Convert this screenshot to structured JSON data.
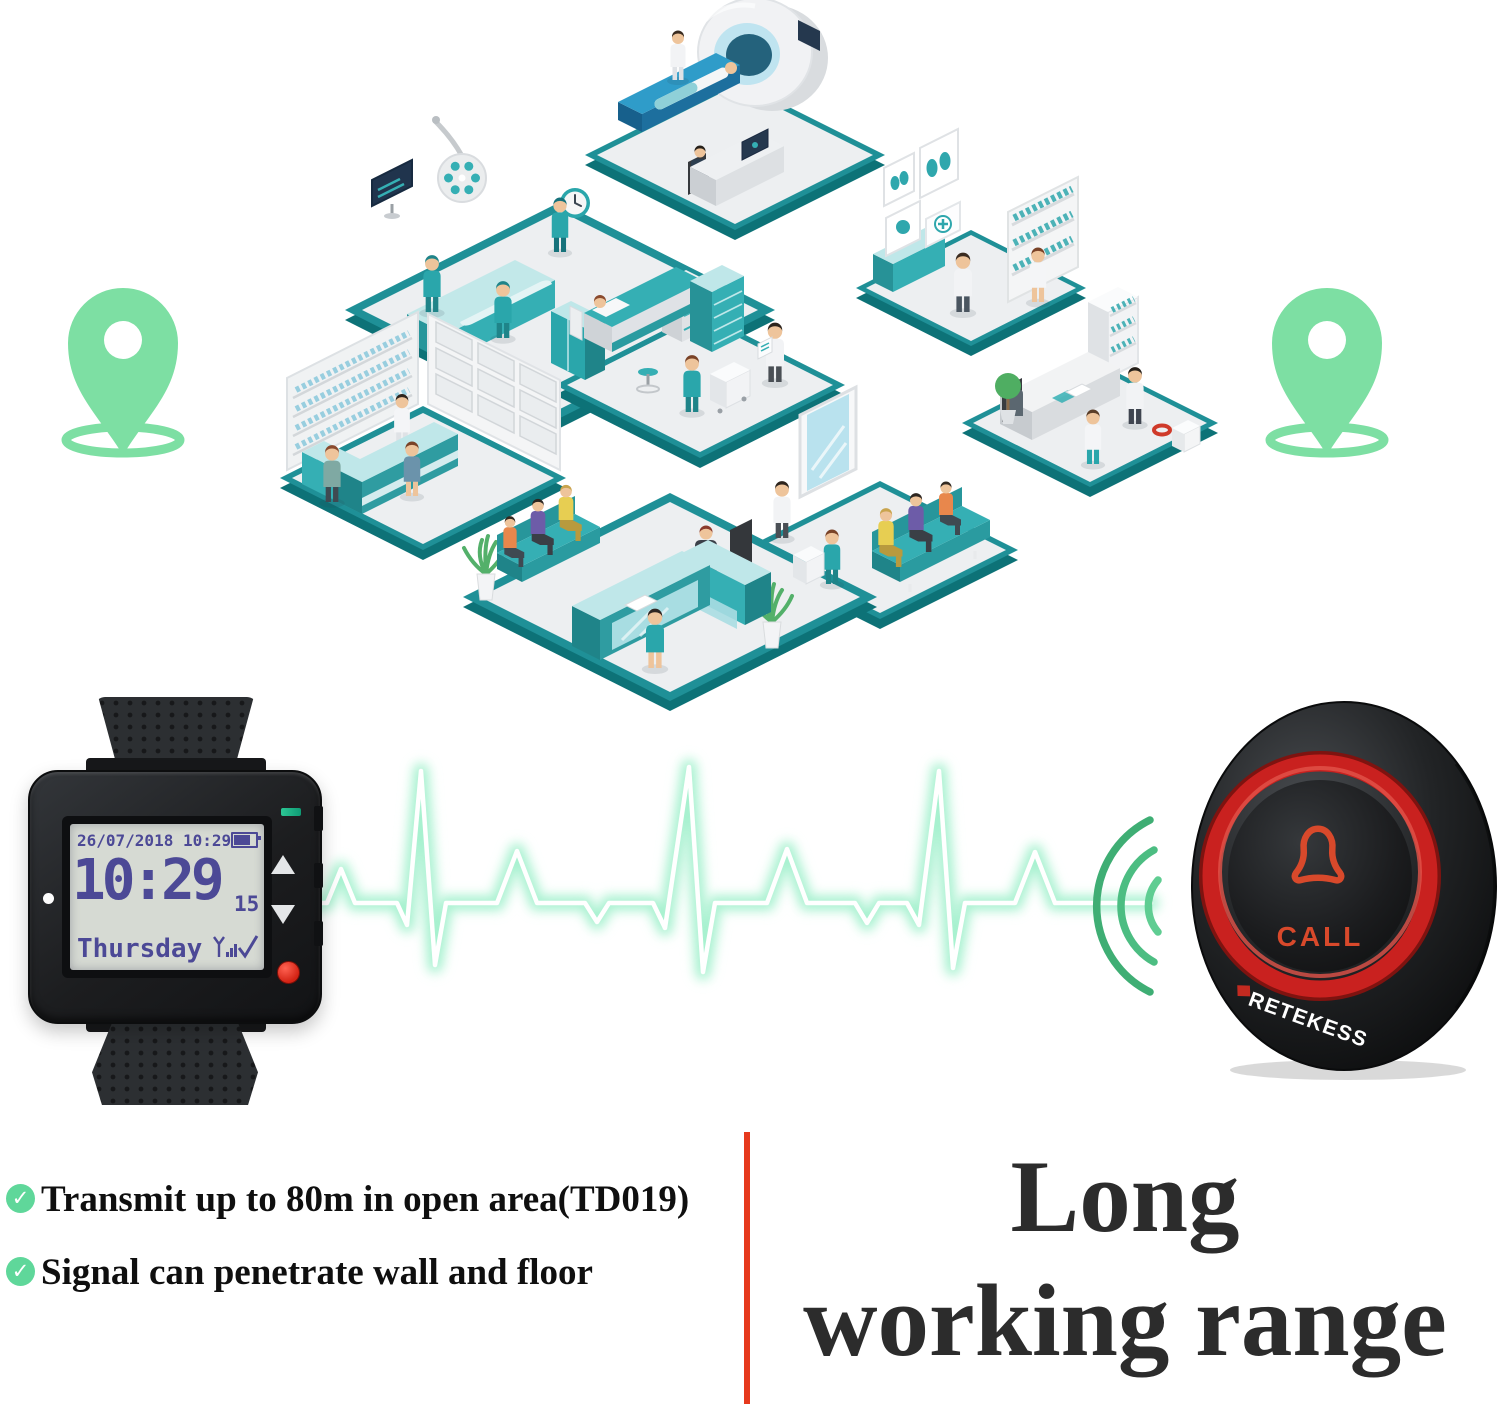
{
  "illustration": {
    "description": "isometric hospital with eight departments",
    "rooms": [
      "mri-scan-room",
      "diagnostics-room",
      "operating-room",
      "patient-ward",
      "doctor-office",
      "pharmacy",
      "waiting-room",
      "reception"
    ],
    "pin_color": "#7ddfa3"
  },
  "watch": {
    "date_line": "26/07/2018 10:29",
    "time": "10:29",
    "seconds": "15",
    "day": "Thursday"
  },
  "call_button": {
    "label": "CALL",
    "brand": "RETEKESS"
  },
  "features": [
    {
      "text": "Transmit up to 80m in open area(TD019)"
    },
    {
      "text": "Signal can penetrate wall and floor"
    }
  ],
  "headline": {
    "line1": "Long",
    "line2": "working range"
  },
  "colors": {
    "accent_red": "#e6391d",
    "teal": "#2aa6ab",
    "teal_dark": "#1f9097",
    "ecg_green": "#9ff0cb",
    "pin_green": "#7ddfa3",
    "button_ring_red": "#c9211f"
  },
  "check_glyph": "✓"
}
